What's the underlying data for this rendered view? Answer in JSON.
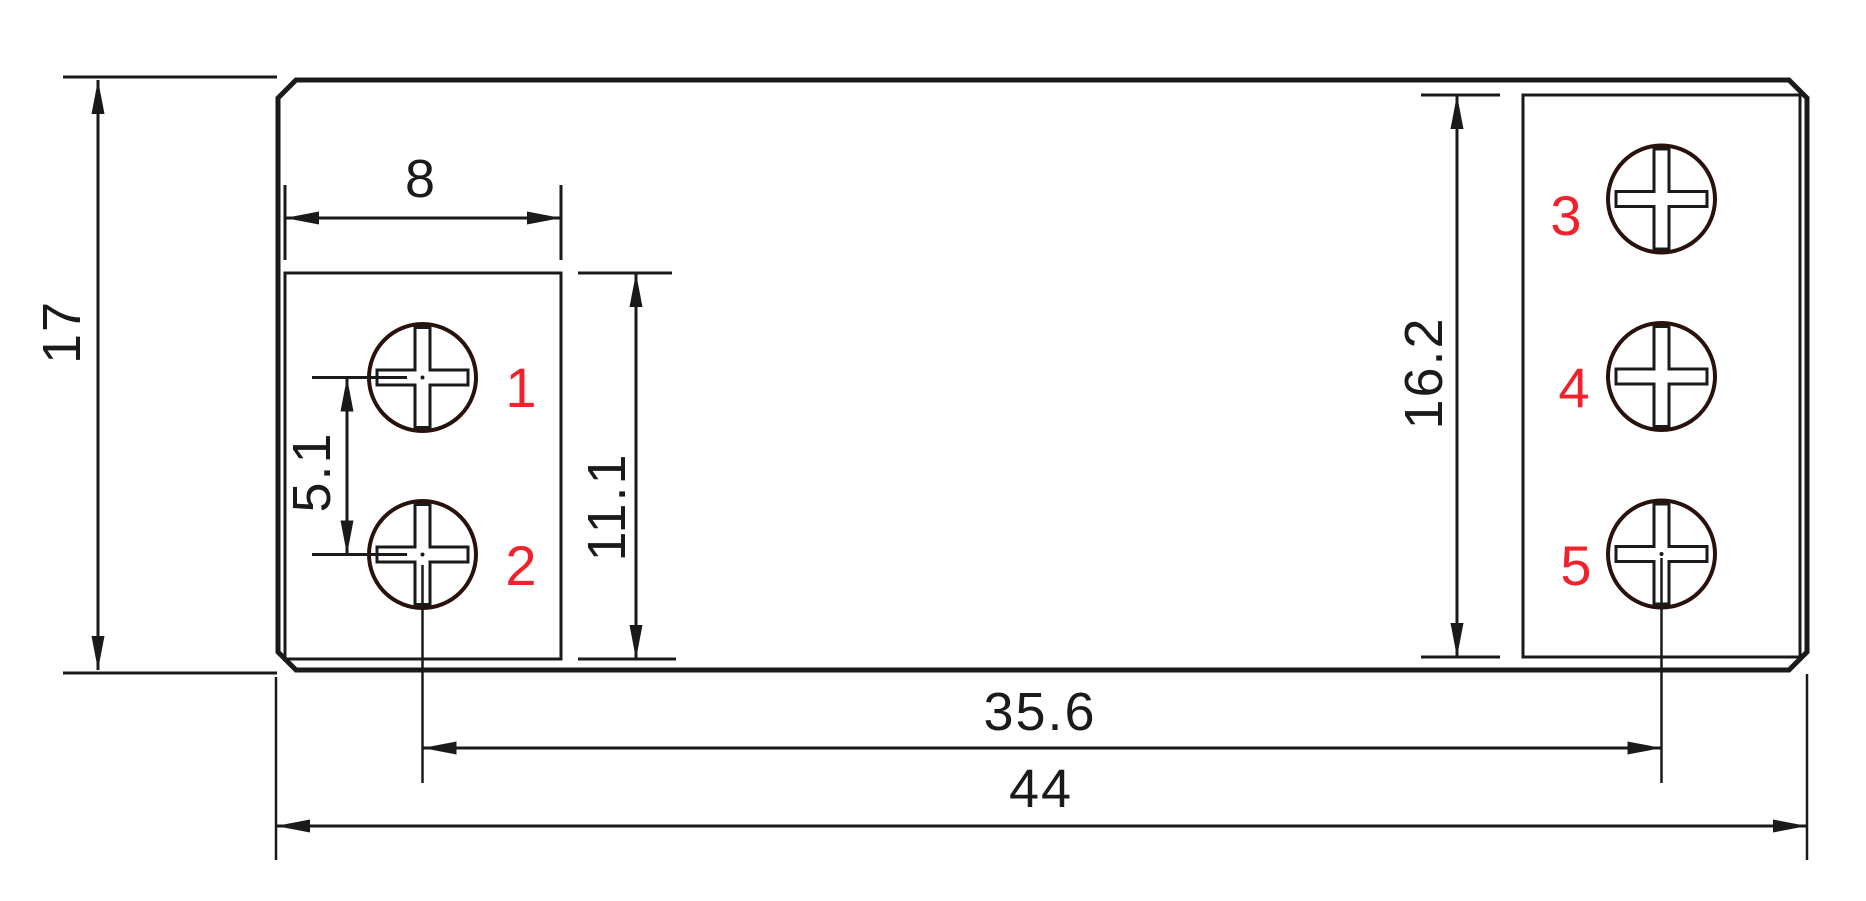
{
  "drawing": {
    "kind": "terminal-footprint-dimension-drawing"
  },
  "dimensions": {
    "overall_height": "17",
    "pad_width": "8",
    "hole_pitch": "5.1",
    "left_pad_height": "11.1",
    "right_pad_height": "16.2",
    "hole_span": "35.6",
    "overall_width": "44"
  },
  "terminals": {
    "labels": [
      "1",
      "2",
      "3",
      "4",
      "5"
    ]
  },
  "colors": {
    "line": "#1a1a1a",
    "screw_outline": "#2a120c",
    "terminal_label": "#f1222b",
    "background": "#ffffff"
  }
}
